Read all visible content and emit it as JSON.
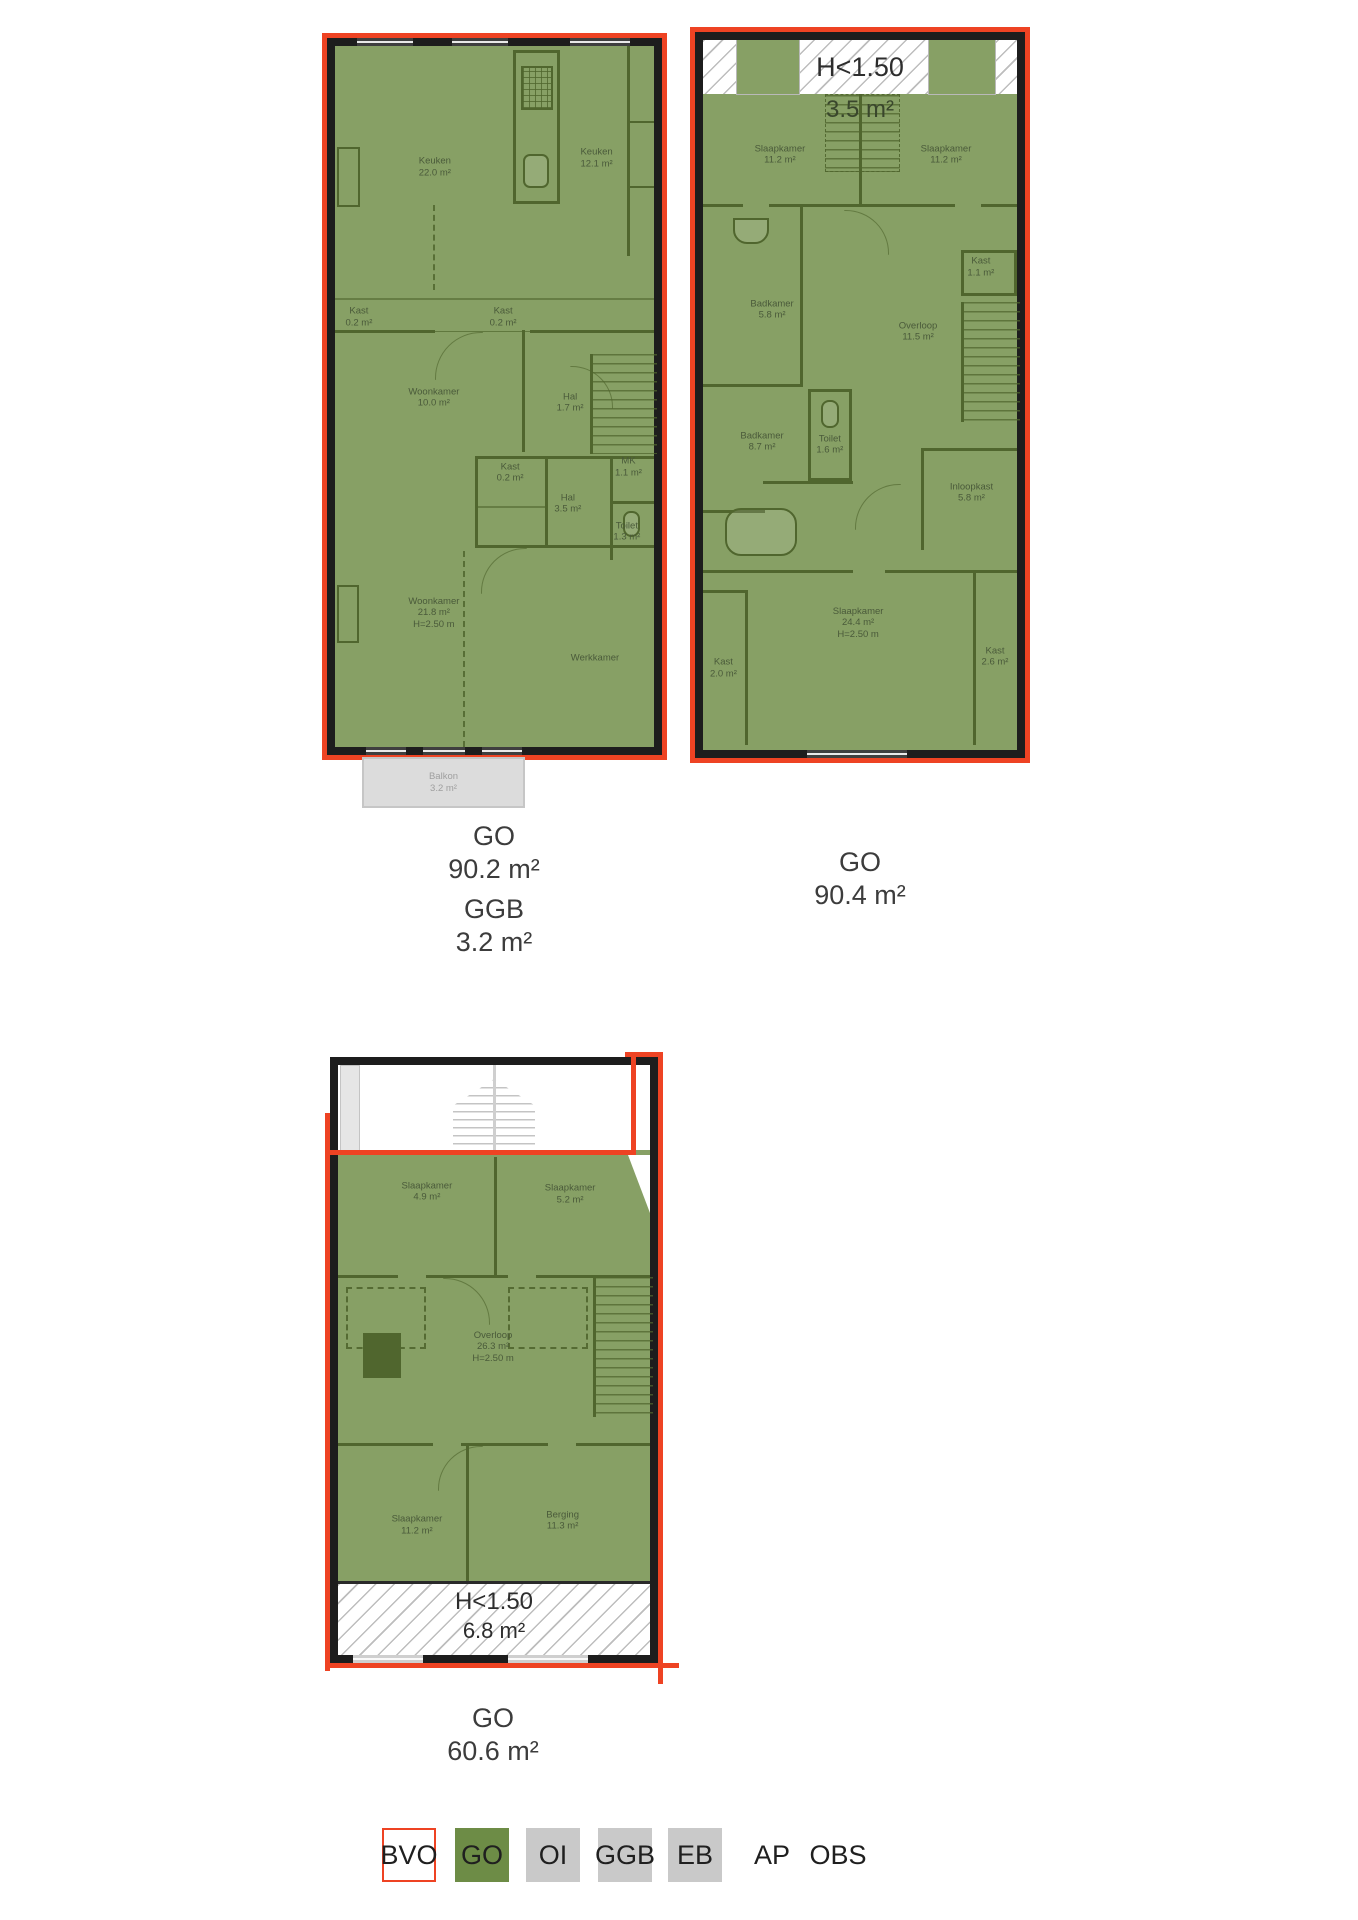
{
  "colors": {
    "bvo_red": "#ee4323",
    "go_green": "#6d8c46",
    "swatch_gray": "#c9c9c9",
    "plan_fill": "#87a065"
  },
  "floor1": {
    "rooms": [
      {
        "name": "Keuken",
        "area": "22.0 m²",
        "x": 31.3,
        "y": 17.3
      },
      {
        "name": "Keuken",
        "area": "12.1 m²",
        "x": 82,
        "y": 16
      },
      {
        "name": "Kast",
        "area": "0.2 m²",
        "x": 7.5,
        "y": 38.7
      },
      {
        "name": "Kast",
        "area": "0.2 m²",
        "x": 52.7,
        "y": 38.7
      },
      {
        "name": "Woonkamer",
        "area": "10.0 m²",
        "x": 31,
        "y": 50.2
      },
      {
        "name": "Hal",
        "area": "1.7 m²",
        "x": 73.7,
        "y": 50.9
      },
      {
        "name": "Kast",
        "area": "0.2 m²",
        "x": 54.9,
        "y": 60.9
      },
      {
        "name": "MK",
        "area": "1.1 m²",
        "x": 92,
        "y": 60.1
      },
      {
        "name": "Hal",
        "area": "3.5 m²",
        "x": 73,
        "y": 65.3
      },
      {
        "name": "Toilet",
        "area": "1.3 m²",
        "x": 91.5,
        "y": 69.3
      },
      {
        "name": "Woonkamer",
        "area": "21.8 m²",
        "height": "H=2.50 m",
        "x": 31,
        "y": 80.9
      },
      {
        "name": "Werkkamer",
        "x": 81.5,
        "y": 87.3
      }
    ],
    "balcony": {
      "name": "Balkon",
      "area": "3.2 m²"
    },
    "totals": {
      "go_label": "GO",
      "go_value": "90.2 m²",
      "ggb_label": "GGB",
      "ggb_value": "3.2 m²"
    }
  },
  "floor2": {
    "low_headroom": {
      "label": "H<1.50",
      "area": "3.5 m²"
    },
    "rooms": [
      {
        "name": "Slaapkamer",
        "area": "11.2 m²",
        "x": 24.5,
        "y": 16.2
      },
      {
        "name": "Slaapkamer",
        "area": "11.2 m²",
        "x": 77.4,
        "y": 16.2
      },
      {
        "name": "Kast",
        "area": "1.1 m²",
        "x": 88.5,
        "y": 32
      },
      {
        "name": "Badkamer",
        "area": "5.8 m²",
        "x": 22,
        "y": 38
      },
      {
        "name": "Overloop",
        "area": "11.5 m²",
        "x": 68.5,
        "y": 41.1
      },
      {
        "name": "Badkamer",
        "area": "8.7 m²",
        "x": 18.8,
        "y": 56.6
      },
      {
        "name": "Toilet",
        "area": "1.6 m²",
        "x": 40.4,
        "y": 57
      },
      {
        "name": "Inloopkast",
        "area": "5.8 m²",
        "x": 85.5,
        "y": 63.8
      },
      {
        "name": "Slaapkamer",
        "area": "24.4 m²",
        "height": "H=2.50 m",
        "x": 49.4,
        "y": 82.1
      },
      {
        "name": "Kast",
        "area": "2.0 m²",
        "x": 6.5,
        "y": 88.5
      },
      {
        "name": "Kast",
        "area": "2.6 m²",
        "x": 93,
        "y": 86.9
      }
    ],
    "totals": {
      "go_label": "GO",
      "go_value": "90.4 m²"
    }
  },
  "floor3": {
    "rooms": [
      {
        "name": "Slaapkamer",
        "area": "4.9 m²",
        "x": 28.5,
        "y": 21.5
      },
      {
        "name": "Slaapkamer",
        "area": "5.2 m²",
        "x": 74.4,
        "y": 21.9
      },
      {
        "name": "Overloop",
        "area": "26.3 m²",
        "height": "H=2.50 m",
        "x": 49.7,
        "y": 47.8
      },
      {
        "name": "Slaapkamer",
        "area": "11.2 m²",
        "x": 25.3,
        "y": 78
      },
      {
        "name": "Berging",
        "area": "11.3 m²",
        "x": 72,
        "y": 77.3
      }
    ],
    "low_headroom": {
      "label": "H<1.50",
      "area": "6.8 m²"
    },
    "totals": {
      "go_label": "GO",
      "go_value": "60.6 m²"
    }
  },
  "legend": {
    "items": [
      {
        "label": "BVO",
        "swatch": "bvo"
      },
      {
        "label": "GO",
        "swatch": "go"
      },
      {
        "label": "OI",
        "swatch": "gray"
      },
      {
        "label": "GGB",
        "swatch": "gray"
      },
      {
        "label": "EB",
        "swatch": "gray"
      },
      {
        "label": "AP",
        "swatch": "none"
      },
      {
        "label": "OBS",
        "swatch": "none"
      }
    ]
  }
}
